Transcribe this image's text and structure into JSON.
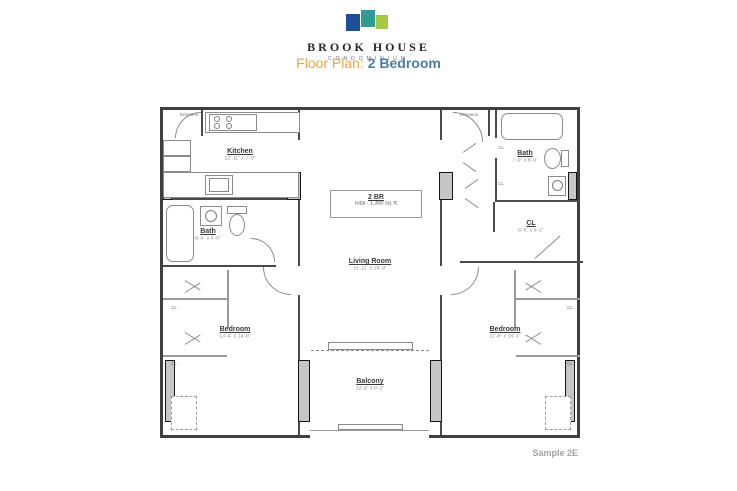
{
  "header": {
    "brand": "BROOK HOUSE",
    "brand_sub": "CONDOMINIUM",
    "logo_colors": {
      "blue": "#1d4e9a",
      "teal": "#2f9d94",
      "green": "#a6c843"
    },
    "title_prefix": "Floor Plan:",
    "title_value": "2 Bedroom",
    "title_prefix_color": "#eba54e",
    "title_value_color": "#4c7ba3"
  },
  "plan": {
    "unit_box": {
      "line1": "2 BR",
      "line2": "Total - 1,300 sq. ft."
    },
    "entrance_label": "Entrance",
    "closet_label": "CL",
    "rooms": {
      "kitchen": {
        "label": "Kitchen",
        "dims": "12'-11\" x 7'-9\""
      },
      "bath_left": {
        "label": "Bath",
        "dims": "8'-5\" x 5'-0\""
      },
      "bedroom_left": {
        "label": "Bedroom",
        "dims": "13'-4\" x 14'-8\""
      },
      "living_room": {
        "label": "Living Room",
        "dims": "15'-11\" x 24'-8\""
      },
      "balcony": {
        "label": "Balcony",
        "dims": "12'-8\" x 6'-0\""
      },
      "bath_right": {
        "label": "Bath",
        "dims": "7'-0\" x 8'-0\""
      },
      "closet_right": {
        "label": "CL",
        "dims": "6'-6\" x 5'-2\""
      },
      "bedroom_right": {
        "label": "Bedroom",
        "dims": "11'-6\" x 16'-1\""
      }
    }
  },
  "footer": {
    "sample_label": "Sample 2E"
  }
}
